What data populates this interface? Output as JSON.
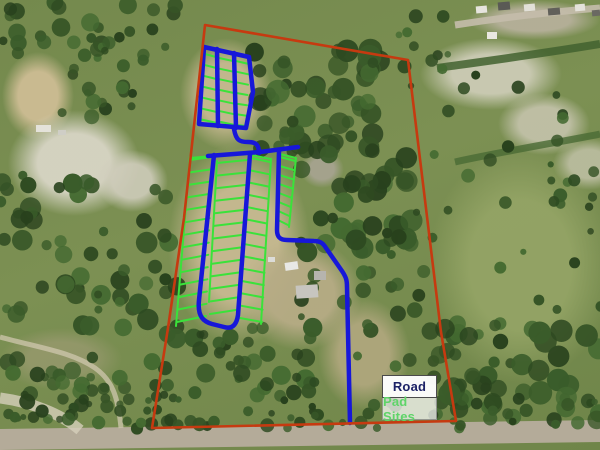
{
  "map": {
    "description": "aerial-property-map-with-site-plan-overlay"
  },
  "legend": {
    "items": [
      {
        "id": "road",
        "label": "Road",
        "color": "#1c2266"
      },
      {
        "id": "pad-sites",
        "label": "Pad Sites",
        "color": "#5fd469"
      }
    ]
  },
  "overlay": {
    "boundary_color": "#c63a10",
    "road_color": "#1717d9",
    "pad_color": "#3ae23a"
  }
}
